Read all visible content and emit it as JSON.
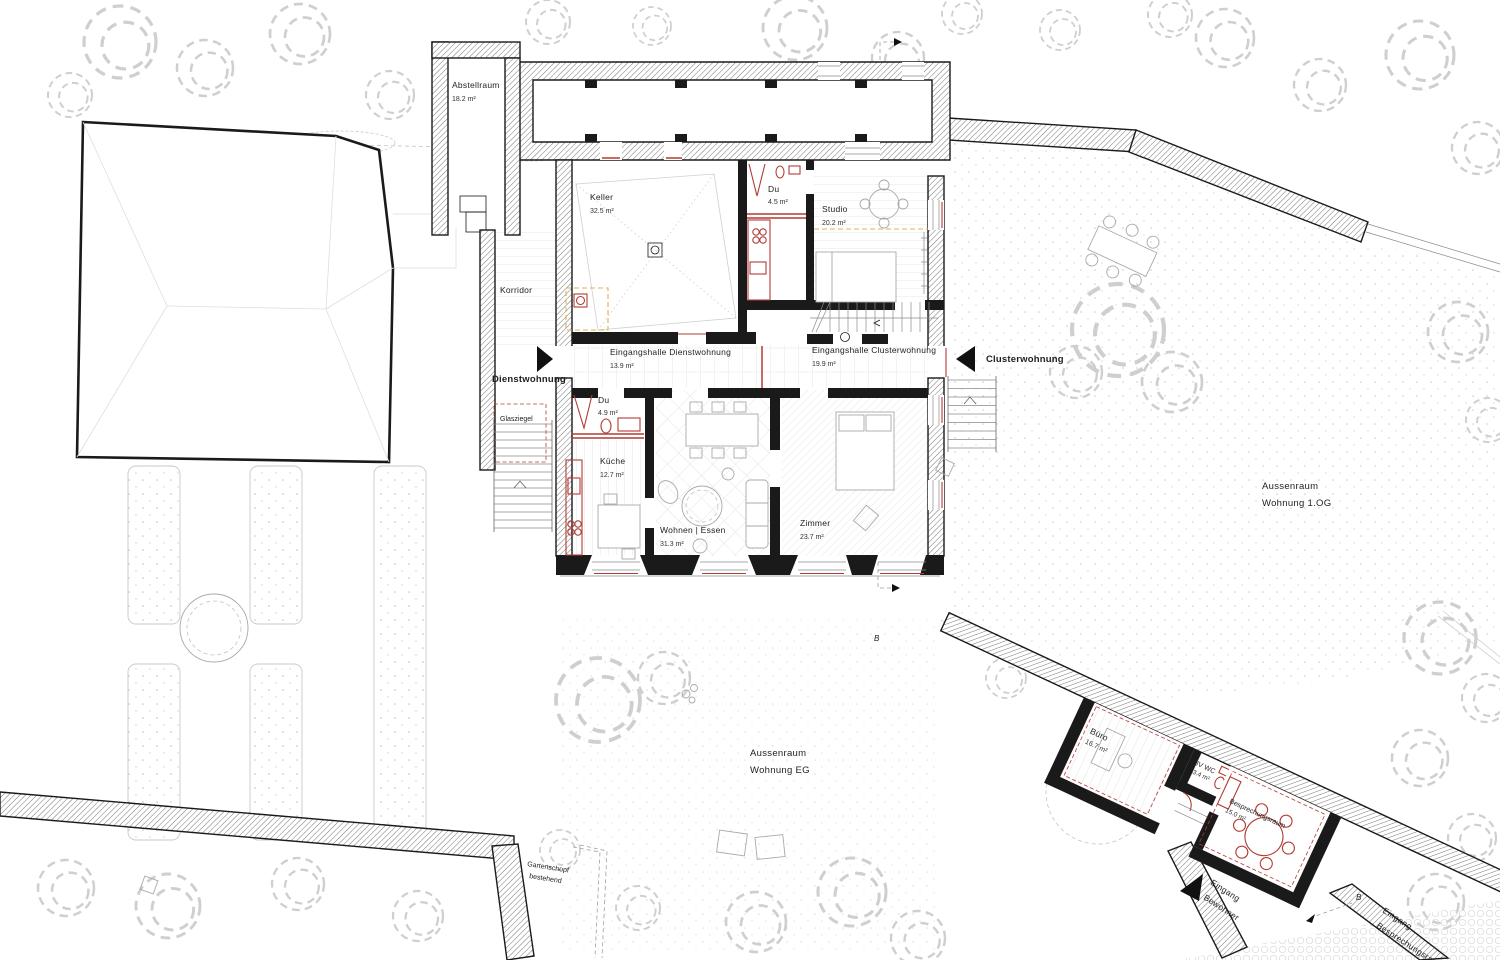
{
  "rooms": {
    "abstellraum": {
      "label": "Abstellraum",
      "area": "18.2 m²"
    },
    "keller": {
      "label": "Keller",
      "area": "32.5 m²"
    },
    "korridor": {
      "label": "Korridor"
    },
    "du_og": {
      "label": "Du",
      "area": "4.5 m²"
    },
    "studio": {
      "label": "Studio",
      "area": "20.2 m²"
    },
    "halle_dienst": {
      "label": "Eingangshalle Dienstwohnung",
      "area": "13.9 m²"
    },
    "halle_cluster": {
      "label": "Eingangshalle Clusterwohnung",
      "area": "19.9 m²"
    },
    "du_eg": {
      "label": "Du",
      "area": "4.9 m²"
    },
    "kueche": {
      "label": "Küche",
      "area": "12.7 m²"
    },
    "wohnen": {
      "label": "Wohnen | Essen",
      "area": "31.3 m²"
    },
    "zimmer": {
      "label": "Zimmer",
      "area": "23.7 m²"
    },
    "buero": {
      "label": "Büro",
      "area": "16.7 m²"
    },
    "wc": {
      "label": "IV WC",
      "area": "3.4 m²"
    },
    "besprechung": {
      "label": "Besprechungsraum",
      "area": "15.0 m²"
    }
  },
  "entrances": {
    "dienstwohnung": "Dienstwohnung",
    "clusterwohnung": "Clusterwohnung",
    "bewohner_line1": "Eingang",
    "bewohner_line2": "Bewohner",
    "besprechung_line1": "Eingang",
    "besprechung_line2": "Besprechungsraum"
  },
  "outdoor": {
    "og_line1": "Aussenraum",
    "og_line2": "Wohnung 1.OG",
    "eg_line1": "Aussenraum",
    "eg_line2": "Wohnung EG",
    "glasziegel": "Glasziegel",
    "schopf_line1": "Gartenschopf",
    "schopf_line2": "bestehend"
  },
  "markers": {
    "section": "B"
  },
  "colors": {
    "wall": "#1a1a1a",
    "new_construction": "#b23c34",
    "accent": "#dcb54e"
  }
}
